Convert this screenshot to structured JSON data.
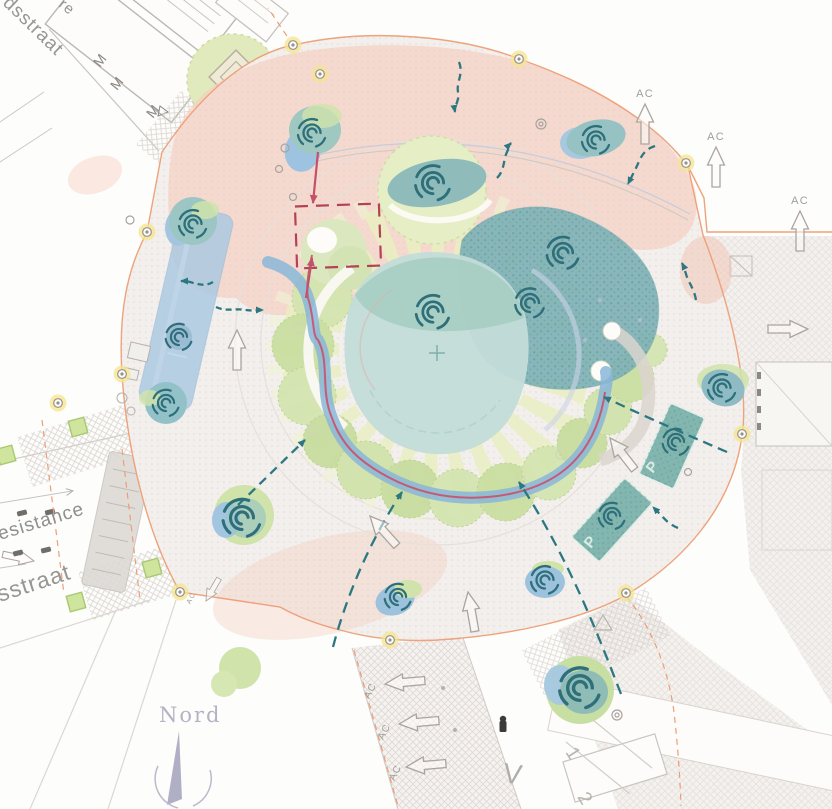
{
  "title": "Roundabout landscape masterplan",
  "streets": {
    "top_fragment": "re",
    "top": "dsstraat",
    "left_upper": "esistance",
    "left_lower": "sstraat"
  },
  "compass": {
    "north_label": "Nord"
  },
  "annotations": {
    "ac_label": "AC",
    "v_label": "V",
    "planter_letter": "P",
    "parking_numbers": [
      "1",
      "2"
    ]
  },
  "palette": {
    "perimeter_orange": "#ec9e76",
    "flow_teal": "#2c7780",
    "accent_red": "#c4506b",
    "stream_blue": "#8ab6d8",
    "pink_zone": "#f6cfc1",
    "pond_teal": "#c3ddd8",
    "shrub_teal": "#7fb2b6",
    "canopy_green": "#cfe3aa",
    "ray_green": "#e9efc0",
    "lamp_glow": "#f5e48d",
    "compass_gray": "#b5b2c6"
  }
}
